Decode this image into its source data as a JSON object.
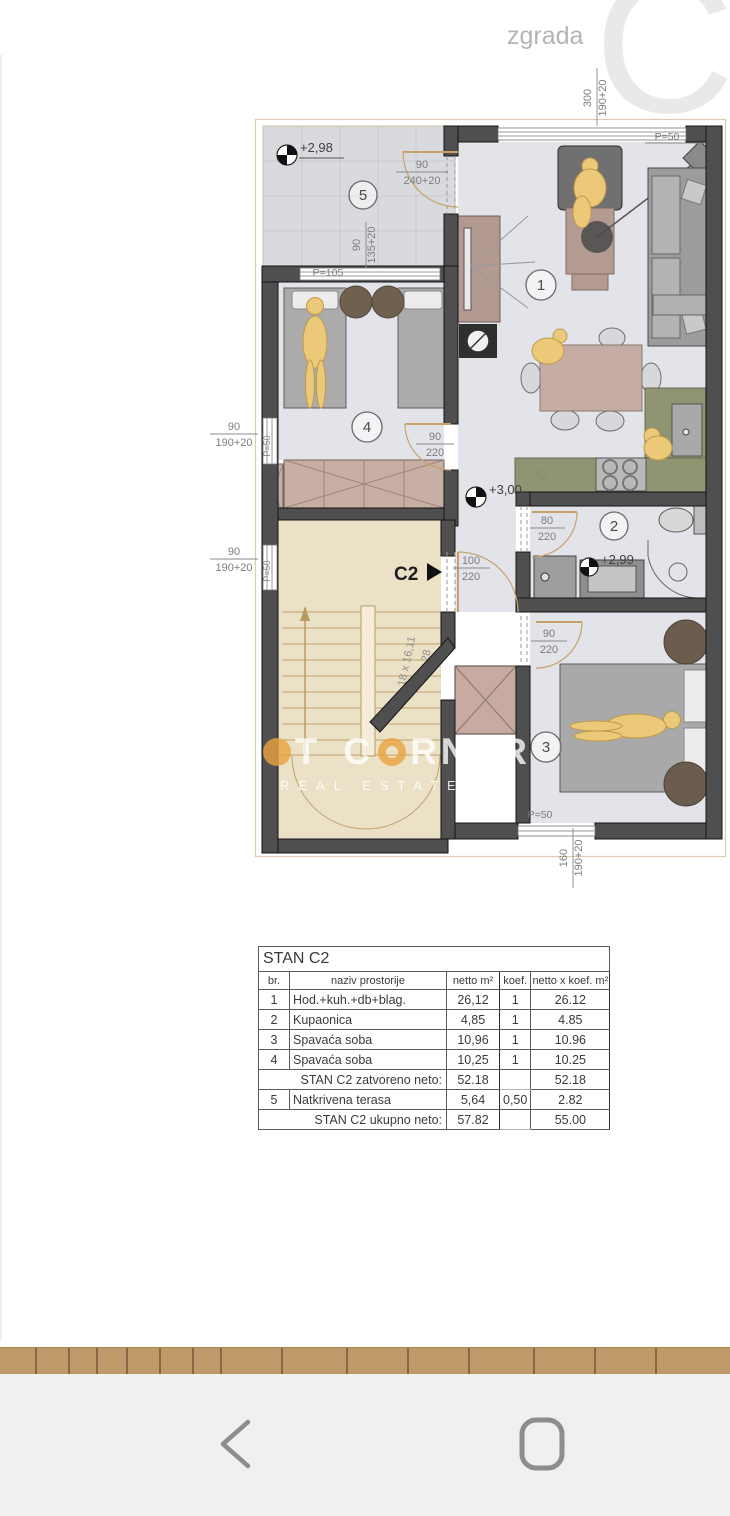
{
  "building": {
    "wing_label": "zgrada",
    "letter": "C"
  },
  "plan": {
    "room_numbers": {
      "r1": "1",
      "r2": "2",
      "r3": "3",
      "r4": "4",
      "r5": "5"
    },
    "entrance": {
      "label": "C2"
    },
    "elevations": {
      "terrace": "+2,98",
      "hall": "+3,00",
      "bathroom": "+2,99"
    },
    "stairs": {
      "count": "18 x 16,11",
      "tread": "17 x 28"
    },
    "dims": {
      "top": {
        "w": "300",
        "h": "190+20"
      },
      "terrace_right": {
        "w": "90",
        "h": "240+20"
      },
      "terrace_bottom": {
        "w": "90",
        "h": "135+20"
      },
      "left_upper": {
        "w": "90",
        "h": "190+20"
      },
      "left_lower": {
        "w": "90",
        "h": "190+20"
      },
      "bottom": {
        "w": "160",
        "h": "190+20"
      },
      "door_room4": {
        "w": "90",
        "h": "220"
      },
      "door_entry": {
        "w": "100",
        "h": "220"
      },
      "door_bath": {
        "w": "80",
        "h": "220"
      },
      "door_room3": {
        "w": "90",
        "h": "220"
      }
    },
    "parapets": {
      "top": "P=50",
      "terrace": "P=105",
      "left_upper": "P=50",
      "left_lower": "P=50",
      "bottom": "P=50"
    }
  },
  "watermark": {
    "w1a": "H",
    "w1b": "T",
    "w2a": "C",
    "w2b": "RNER",
    "line2": "REAL ESTATE"
  },
  "table": {
    "title": "STAN C2",
    "headers": [
      "br.",
      "naziv prostorije",
      "netto m²",
      "koef.",
      "netto x koef. m²"
    ],
    "rows": [
      {
        "br": "1",
        "name": "Hod.+kuh.+db+blag.",
        "netto": "26,12",
        "koef": "1",
        "total": "26.12"
      },
      {
        "br": "2",
        "name": "Kupaonica",
        "netto": "4,85",
        "koef": "1",
        "total": "4.85"
      },
      {
        "br": "3",
        "name": "Spavaća soba",
        "netto": "10,96",
        "koef": "1",
        "total": "10.96"
      },
      {
        "br": "4",
        "name": "Spavaća soba",
        "netto": "10,25",
        "koef": "1",
        "total": "10.25"
      }
    ],
    "subtotal": {
      "label": "STAN C2 zatvoreno neto:",
      "netto": "52.18",
      "total": "52.18"
    },
    "row5": {
      "br": "5",
      "name": "Natkrivena terasa",
      "netto": "5,64",
      "koef": "0,50",
      "total": "2.82"
    },
    "grand": {
      "label": "STAN C2 ukupno neto:",
      "netto": "57.82",
      "total": "55.00"
    }
  },
  "colors": {
    "accent_tan": "#bd9a68",
    "wall": "#4f4f4f",
    "stair_floor": "#ebe1c6",
    "room_floor": "#e2e4e9",
    "kitchen": "#8f9472",
    "watermark_orange": "#e8a33d"
  }
}
